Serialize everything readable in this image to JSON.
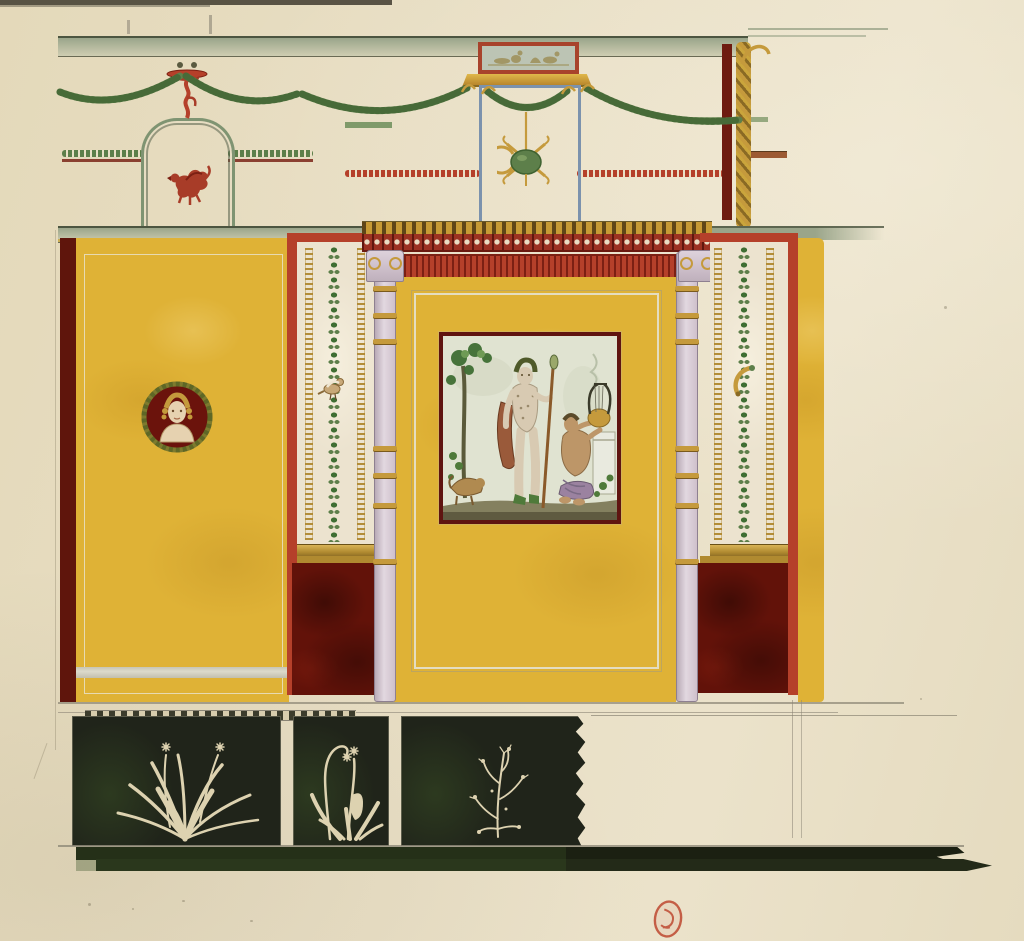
{
  "artwork": {
    "subject": "pompeii-wall-decoration-elevation-watercolour",
    "registers": [
      "upper-white-frieze-with-garlands",
      "middle-yellow-panels-with-aedicula",
      "black-predella-with-plants",
      "dark-baseboard"
    ],
    "figures": {
      "niche_animal": "red-griffin-leaping",
      "medallion": "bust-portrait-on-dark-red-ground",
      "central_picture": "standing-dionysus-with-thyrsus-and-seated-satyr-playing-lyre",
      "plaque": "miniature-tablet-scene",
      "pendant": "green-patera-with-crossed-gold-ribbons",
      "left_pilaster_ornament": "perched-bird",
      "right_pilaster_ornament": "gold-cornucopia",
      "frieze_plants": [
        "grass-tuft-with-flower-stalks",
        "narcissus-with-curled-stem",
        "thorny-shrub"
      ],
      "stamp": "red-oval-collection-stamp"
    },
    "counts": {
      "frieze_panels": 3,
      "aedicula_columns": 2,
      "pilaster_strips": 2
    }
  },
  "palette": {
    "paper": "#e7ddc2",
    "paper_edge": "#3f3b2f",
    "pencil": "#8a8474",
    "cornice_green": "#9aa58a",
    "ochre_yellow": "#dfb236",
    "ochre_deep": "#c9992a",
    "vermilion_red": "#b5402a",
    "vermilion_deep": "#7c2013",
    "maroon": "#621209",
    "garland_green": "#5d7f4a",
    "garland_green_dark": "#3f6231",
    "foliage_dark": "#3f6e33",
    "gold": "#c59a3c",
    "gold_dark": "#8a6a24",
    "lilac_column": "#d8cbd3",
    "lilac_outline": "#8e8090",
    "frame_blue": "#7b92ad",
    "plaque_grey": "#bcc4b4",
    "picture_bg": "#e0e3d1",
    "skin_pale": "#d8cab2",
    "skin_tan": "#bd9668",
    "drape_purple": "#9b82a0",
    "drape_rust": "#9a5a3a",
    "frieze_black": "#20241a",
    "base_olive": "#2e3a20",
    "plant_cream": "#ddd2b0",
    "stamp_red": "#c05038",
    "white_line": "#d8d5c4"
  }
}
